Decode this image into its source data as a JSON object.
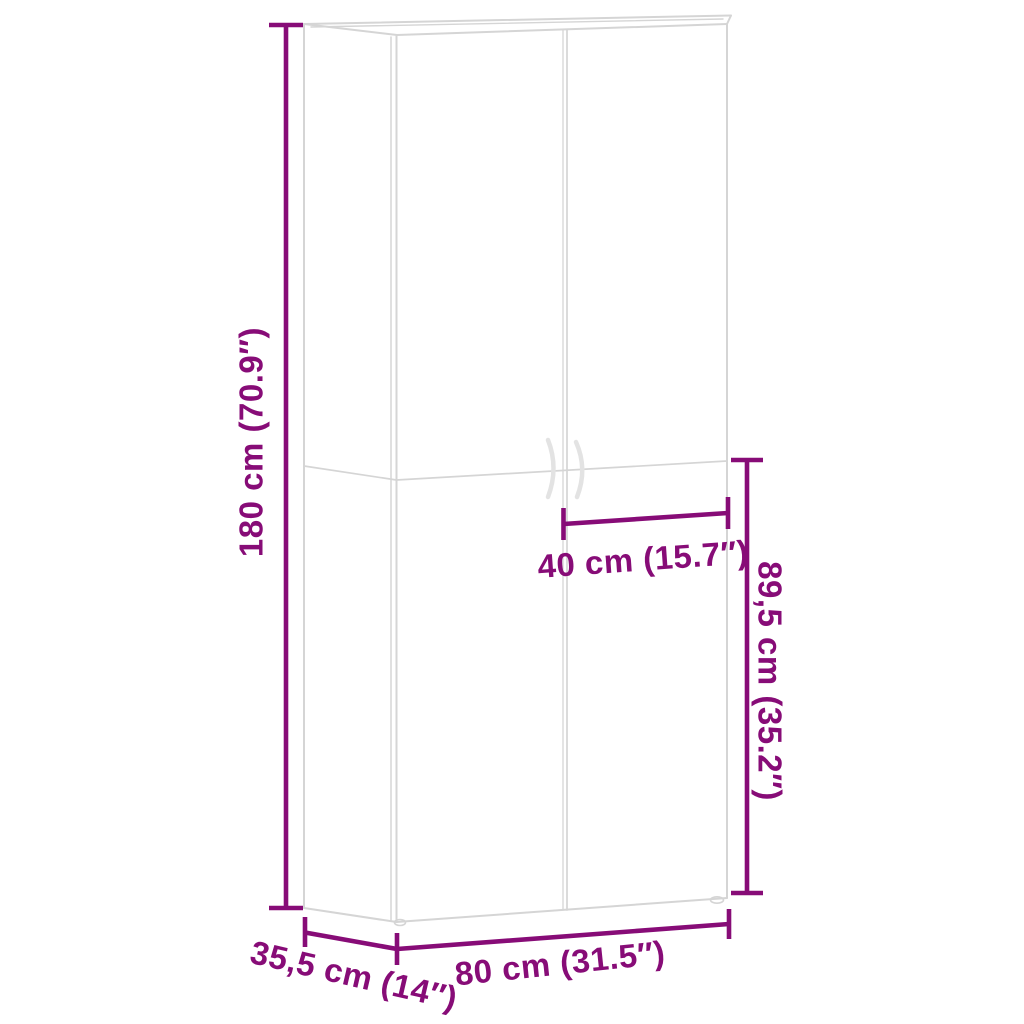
{
  "diagram": {
    "description": "Dimension diagram of a tall two-door cabinet shown in light outline perspective",
    "background": "#ffffff"
  },
  "colors": {
    "dimension": "#870c77",
    "outline": "#d5d5d5",
    "outline_light": "#e3e3e3"
  },
  "dimensions": {
    "height": {
      "label": "180 cm (70.9″)",
      "cm": "180",
      "inches": "70.9"
    },
    "door_width": {
      "label": "40 cm (15.7″)",
      "cm": "40",
      "inches": "15.7"
    },
    "lower_height": {
      "label": "89,5 cm (35.2″)",
      "cm": "89,5",
      "inches": "35.2"
    },
    "width": {
      "label": "80 cm (31.5″)",
      "cm": "80",
      "inches": "31.5"
    },
    "depth": {
      "label": "35,5 cm (14″)",
      "cm": "35,5",
      "inches": "14"
    }
  }
}
